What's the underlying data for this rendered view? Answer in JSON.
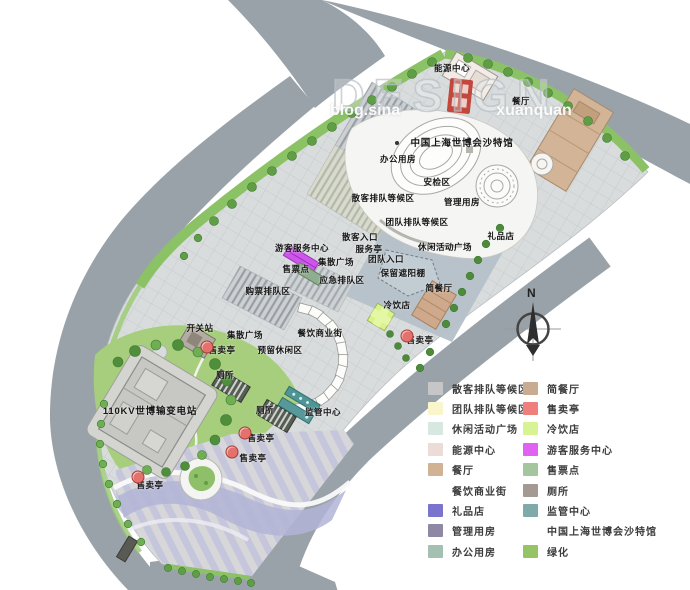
{
  "watermark": {
    "design_text": "DESIGN",
    "blog_left": "blog.sina",
    "blog_right": "xuanquan"
  },
  "compass": {
    "north_label": "N"
  },
  "plan": {
    "labels": [
      {
        "text": "能源中心",
        "x": 452,
        "y": 68
      },
      {
        "text": "餐厅",
        "x": 521,
        "y": 101
      },
      {
        "text": "中国上海世博会沙特馆",
        "x": 462,
        "y": 142,
        "big": true
      },
      {
        "text": "办公用房",
        "x": 398,
        "y": 159
      },
      {
        "text": "安检区",
        "x": 437,
        "y": 182
      },
      {
        "text": "散客排队等候区",
        "x": 383,
        "y": 198
      },
      {
        "text": "管理用房",
        "x": 462,
        "y": 202
      },
      {
        "text": "团队排队等候区",
        "x": 417,
        "y": 222
      },
      {
        "text": "散客入口",
        "x": 360,
        "y": 237
      },
      {
        "text": "服务亭",
        "x": 369,
        "y": 249
      },
      {
        "text": "团队入口",
        "x": 386,
        "y": 259
      },
      {
        "text": "集散广场",
        "x": 336,
        "y": 262
      },
      {
        "text": "休闲活动广场",
        "x": 445,
        "y": 247
      },
      {
        "text": "礼品店",
        "x": 501,
        "y": 236
      },
      {
        "text": "游客服务中心",
        "x": 302,
        "y": 248
      },
      {
        "text": "售票点",
        "x": 296,
        "y": 269
      },
      {
        "text": "应急排队区",
        "x": 342,
        "y": 280
      },
      {
        "text": "保留遮阳棚",
        "x": 403,
        "y": 273
      },
      {
        "text": "购票排队区",
        "x": 268,
        "y": 291
      },
      {
        "text": "简餐厅",
        "x": 439,
        "y": 288
      },
      {
        "text": "冷饮店",
        "x": 397,
        "y": 305
      },
      {
        "text": "售卖亭",
        "x": 420,
        "y": 340
      },
      {
        "text": "开关站",
        "x": 200,
        "y": 328
      },
      {
        "text": "集散广场",
        "x": 245,
        "y": 335
      },
      {
        "text": "餐饮商业街",
        "x": 320,
        "y": 333
      },
      {
        "text": "售卖亭",
        "x": 222,
        "y": 350
      },
      {
        "text": "预留休闲区",
        "x": 280,
        "y": 350
      },
      {
        "text": "厕所",
        "x": 225,
        "y": 375
      },
      {
        "text": "110KV世博输变电站",
        "x": 150,
        "y": 410,
        "big": true
      },
      {
        "text": "厕所",
        "x": 265,
        "y": 410
      },
      {
        "text": "监管中心",
        "x": 323,
        "y": 412
      },
      {
        "text": "售卖亭",
        "x": 261,
        "y": 438
      },
      {
        "text": "售卖亭",
        "x": 253,
        "y": 458
      },
      {
        "text": "售卖亭",
        "x": 150,
        "y": 485
      }
    ],
    "kiosk_markers": [
      {
        "x": 207,
        "y": 347
      },
      {
        "x": 407,
        "y": 336
      },
      {
        "x": 245,
        "y": 433
      },
      {
        "x": 232,
        "y": 452
      },
      {
        "x": 138,
        "y": 477
      }
    ]
  },
  "legend": {
    "left": [
      {
        "label": "散客排队等候区",
        "color": "#c6c6c8"
      },
      {
        "label": "团队排队等候区",
        "color": "#f8f6ca"
      },
      {
        "label": "休闲活动广场",
        "color": "#d7e8e0"
      },
      {
        "label": "能源中心",
        "color": "#eddbd7"
      },
      {
        "label": "餐厅",
        "color": "#d2b295"
      },
      {
        "label": "餐饮商业街",
        "color": null
      },
      {
        "label": "礼品店",
        "color": "#7b74ce"
      },
      {
        "label": "管理用房",
        "color": "#8e88a4"
      },
      {
        "label": "办公用房",
        "color": "#a4c0b3"
      }
    ],
    "right": [
      {
        "label": "简餐厅",
        "color": "#c9ab92"
      },
      {
        "label": "售卖亭",
        "color": "#ee7f7a"
      },
      {
        "label": "冷饮店",
        "color": "#d7f394"
      },
      {
        "label": "游客服务中心",
        "color": "#e161f1"
      },
      {
        "label": "售票点",
        "color": "#a4c59d"
      },
      {
        "label": "厕所",
        "color": "#a49a93"
      },
      {
        "label": "监管中心",
        "color": "#80a9a9"
      },
      {
        "label": "中国上海世博会沙特馆",
        "color": null
      },
      {
        "label": "绿化",
        "color": "#96c464"
      }
    ]
  },
  "colors": {
    "road": "#99a2a9",
    "parcel": "#d9dcdd",
    "green": "#8cc266",
    "seal_red": "#c0392f"
  }
}
